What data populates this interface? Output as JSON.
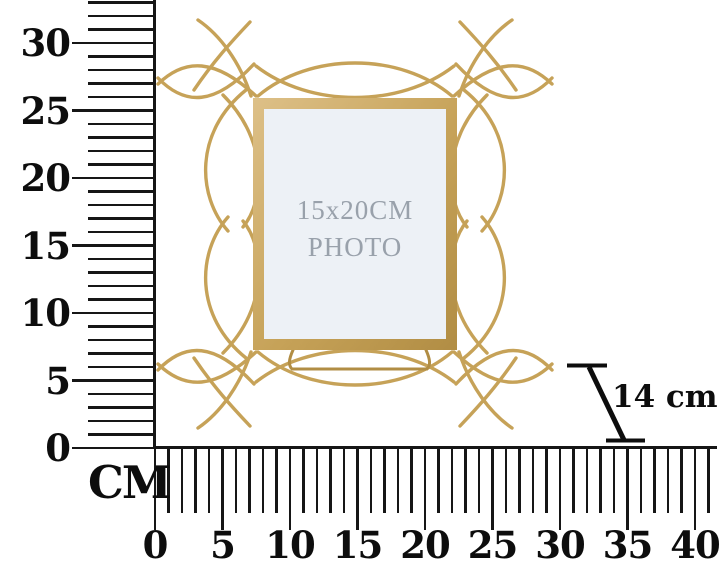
{
  "colors": {
    "gold": "#c6a258",
    "gold_light": "#ddc088",
    "gold_dark": "#b18d44",
    "ink": "#161616",
    "photo_bg": "#edf1f6",
    "photo_text": "#99a1ab"
  },
  "vertical_ruler": {
    "unit_label": "CM",
    "tick_count": 34,
    "label_every": 5,
    "labels": [
      "0",
      "5",
      "10",
      "15",
      "20",
      "25",
      "30"
    ]
  },
  "horizontal_ruler": {
    "tick_count": 42,
    "label_every": 5,
    "labels": [
      "0",
      "5",
      "10",
      "15",
      "20",
      "25",
      "30",
      "35",
      "40"
    ]
  },
  "annotation": {
    "depth_label": "14 cm"
  },
  "frame": {
    "photo_label_line1": "15x20CM",
    "photo_label_line2": "PHOTO"
  }
}
